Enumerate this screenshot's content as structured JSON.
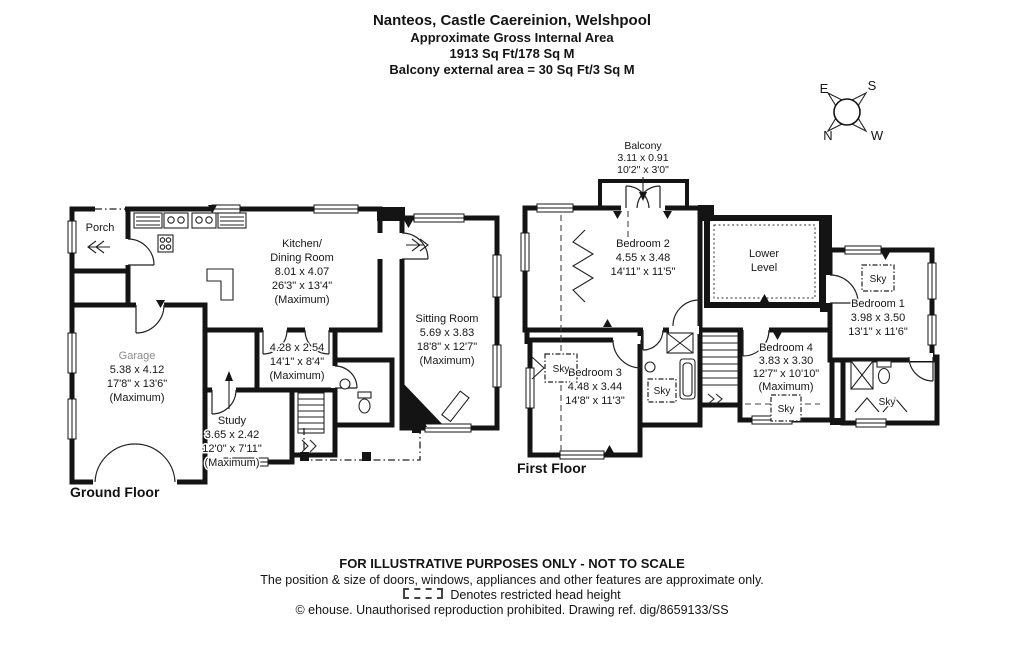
{
  "header": {
    "title": "Nanteos, Castle Caereinion, Welshpool",
    "subtitle": "Approximate Gross Internal Area",
    "area": "1913 Sq Ft/178 Sq M",
    "balcony_area": "Balcony external area = 30 Sq Ft/3 Sq M"
  },
  "compass": {
    "e": "E",
    "s": "S",
    "n": "N",
    "w": "W"
  },
  "ground": {
    "label": "Ground Floor",
    "porch": {
      "name": "Porch"
    },
    "kitchen": {
      "line1": "Kitchen/",
      "line2": "Dining Room",
      "metric": "8.01 x 4.07",
      "imperial": "26'3\" x 13'4\"",
      "note": "(Maximum)"
    },
    "sitting": {
      "name": "Sitting Room",
      "metric": "5.69 x 3.83",
      "imperial": "18'8\" x 12'7\"",
      "note": "(Maximum)"
    },
    "hall": {
      "metric": "4.28 x 2.54",
      "imperial": "14'1\" x 8'4\"",
      "note": "(Maximum)"
    },
    "garage": {
      "name": "Garage",
      "metric": "5.38 x 4.12",
      "imperial": "17'8\" x 13'6\"",
      "note": "(Maximum)"
    },
    "study": {
      "name": "Study",
      "metric": "3.65 x 2.42",
      "imperial": "12'0\" x 7'11\"",
      "note": "(Maximum)"
    }
  },
  "first": {
    "label": "First Floor",
    "balcony": {
      "name": "Balcony",
      "metric": "3.11 x 0.91",
      "imperial": "10'2\" x 3'0\""
    },
    "bedroom2": {
      "name": "Bedroom 2",
      "metric": "4.55 x 3.48",
      "imperial": "14'11\" x 11'5\""
    },
    "lower_level": {
      "line1": "Lower",
      "line2": "Level"
    },
    "bedroom1": {
      "name": "Bedroom 1",
      "metric": "3.98 x 3.50",
      "imperial": "13'1\" x 11'6\""
    },
    "bedroom4": {
      "name": "Bedroom 4",
      "metric": "3.83 x 3.30",
      "imperial": "12'7\" x 10'10\"",
      "note": "(Maximum)"
    },
    "bedroom3": {
      "name": "Bedroom 3",
      "metric": "4.48 x 3.44",
      "imperial": "14'8\" x 11'3\""
    },
    "sky": "Sky"
  },
  "footer": {
    "line1": "FOR ILLUSTRATIVE PURPOSES ONLY - NOT TO SCALE",
    "line2": "The position & size of doors, windows, appliances and other features are approximate only.",
    "line3": "Denotes restricted head height",
    "line4": "© ehouse. Unauthorised reproduction prohibited. Drawing ref. dig/8659133/SS"
  }
}
